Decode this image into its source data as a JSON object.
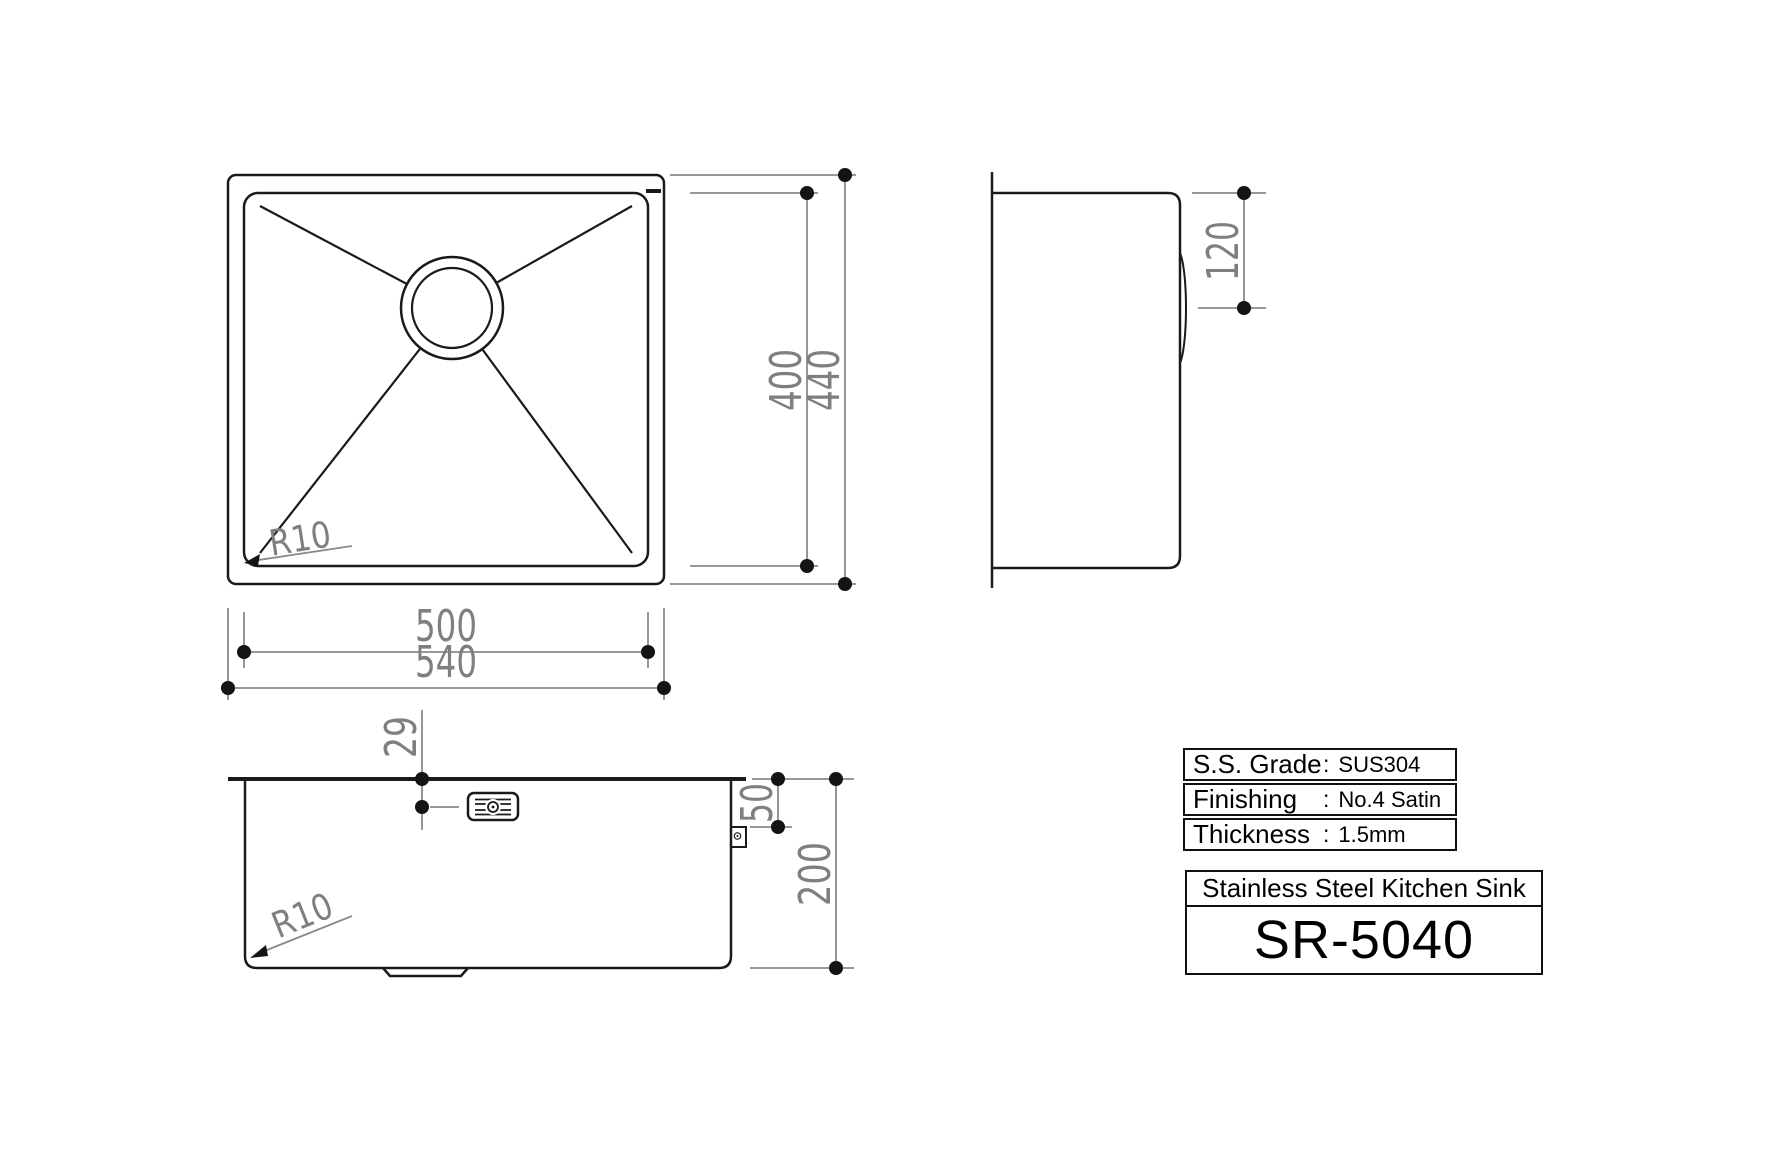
{
  "drawing": {
    "plan_view": {
      "radius_label": "R10",
      "dim_inner_width": "500",
      "dim_outer_width": "540",
      "dim_inner_height": "400",
      "dim_outer_height": "440"
    },
    "side_view": {
      "dim_clip_depth": "120"
    },
    "front_view": {
      "radius_label": "R10",
      "dim_overflow_offset": "29",
      "dim_clip_offset": "50",
      "dim_depth": "200"
    }
  },
  "spec_table": {
    "rows": [
      {
        "label": "S.S. Grade",
        "colon": ":",
        "value": "SUS304"
      },
      {
        "label": "Finishing",
        "colon": ":",
        "value": "No.4 Satin"
      },
      {
        "label": "Thickness",
        "colon": ":",
        "value": "1.5mm"
      }
    ]
  },
  "title_block": {
    "product_name": "Stainless Steel Kitchen Sink",
    "model": "SR-5040"
  },
  "colors": {
    "geometry_line": "#1a1a1a",
    "dimension_line": "#8a8a8a",
    "dimension_text": "#7f7f7f",
    "background": "#ffffff"
  }
}
